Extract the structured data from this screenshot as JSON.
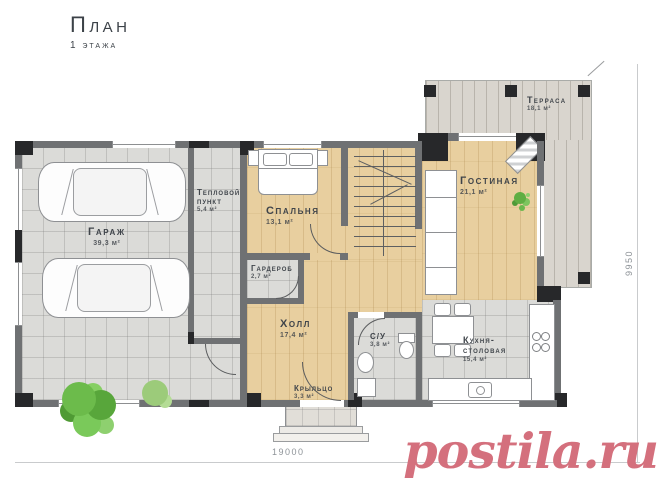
{
  "page": {
    "title": "План",
    "subtitle": "1 этажа"
  },
  "watermark": {
    "text": "postila.ru",
    "color": "#d4707d"
  },
  "dims": {
    "width": "19000",
    "height": "9950"
  },
  "rooms": {
    "garage": {
      "name": "Гараж",
      "area": "39,3 м²"
    },
    "heating": {
      "name": "Тепловой пункт",
      "area": "5,4 м²"
    },
    "bedroom": {
      "name": "Спальня",
      "area": "13,1 м²"
    },
    "wardrobe": {
      "name": "Гардероб",
      "area": "2,7 м²"
    },
    "hall": {
      "name": "Холл",
      "area": "17,4 м²"
    },
    "living": {
      "name": "Гостиная",
      "area": "21,1 м²"
    },
    "terrace": {
      "name": "Терраса",
      "area": "18,1 м²"
    },
    "bathroom": {
      "name": "С/У",
      "area": "3,8 м²"
    },
    "kitchen": {
      "name": "Кухня-столовая",
      "area": "15,4 м²"
    },
    "porch": {
      "name": "Крыльцо",
      "area": "3,3 м²"
    }
  },
  "colors": {
    "wall": "#6f7173",
    "column": "#27282a",
    "wood": "#e8cf9f",
    "tile": "#dbdbd8",
    "deck": "#d9d5ce"
  }
}
